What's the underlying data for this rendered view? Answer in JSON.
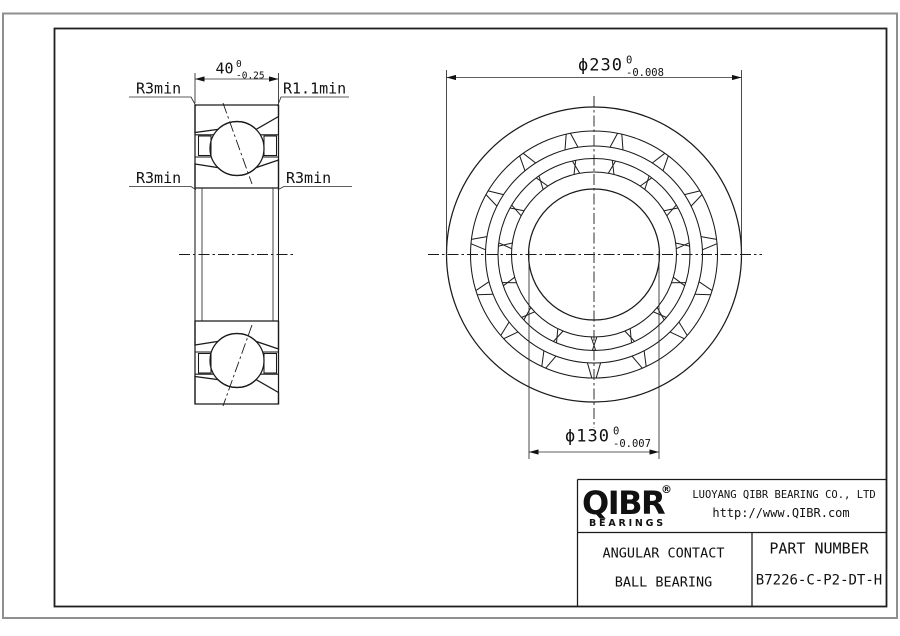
{
  "section_view": {
    "width_dim": {
      "value": "40",
      "tol_upper": "0",
      "tol_lower": "-0.25"
    },
    "label_top_left": "R3min",
    "label_top_right": "R1.1min",
    "label_mid_left": "R3min",
    "label_mid_right": "R3min"
  },
  "front_view": {
    "outer_dim": {
      "text": "ϕ230",
      "tol_upper": "0",
      "tol_lower": "-0.008"
    },
    "bore_dim": {
      "text": "ϕ130",
      "tol_upper": "0",
      "tol_lower": "-0.007"
    }
  },
  "title_block": {
    "logo_text": "QIBR",
    "logo_reg": "®",
    "logo_sub": "BEARINGS",
    "company": "LUOYANG QIBR BEARING CO., LTD",
    "website": "http://www.QIBR.com",
    "product_line1": "ANGULAR CONTACT",
    "product_line2": "BALL BEARING",
    "part_label": "PART NUMBER",
    "part_number": "B7226-C-P2-DT-H"
  },
  "colors": {
    "line": "#1a1a1a",
    "border_gray": "#8f8f8f",
    "background": "#ffffff"
  }
}
